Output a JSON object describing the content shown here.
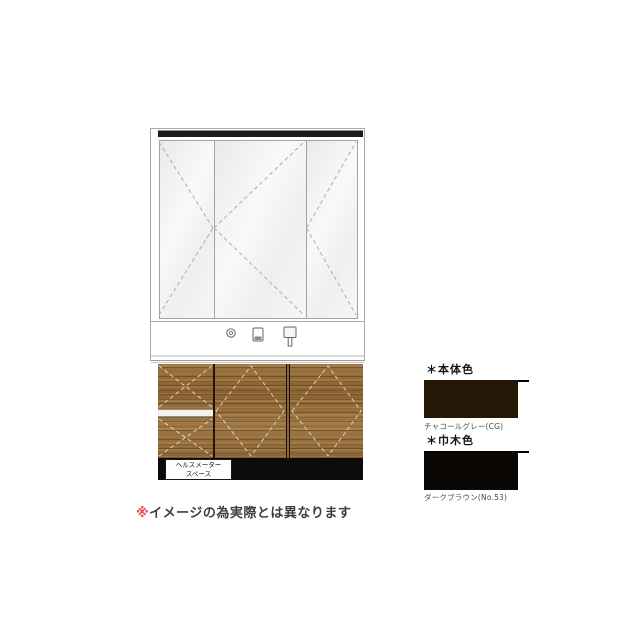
{
  "vanity": {
    "healthmeter_space": {
      "line1": "ヘルスメーター",
      "line2": "スペース"
    }
  },
  "note": {
    "marker": "※",
    "text": "イメージの為実際とは異なります"
  },
  "swatch_panel": {
    "body": {
      "heading": "＊本体色",
      "caption": "チャコールグレー(CG)",
      "color": "#261605"
    },
    "skirting": {
      "heading": "＊巾木色",
      "caption": "ダークブラウン(No.53)",
      "color": "#0a0705"
    }
  },
  "palette": {
    "wood": "#96713f",
    "kickboard": "#0c0b09",
    "mirror_trim": "#1d1b19",
    "note_marker": "#e04a50"
  },
  "icons": {
    "counter": [
      "drain-knob-icon",
      "tumbler-icon",
      "faucet-icon"
    ]
  }
}
